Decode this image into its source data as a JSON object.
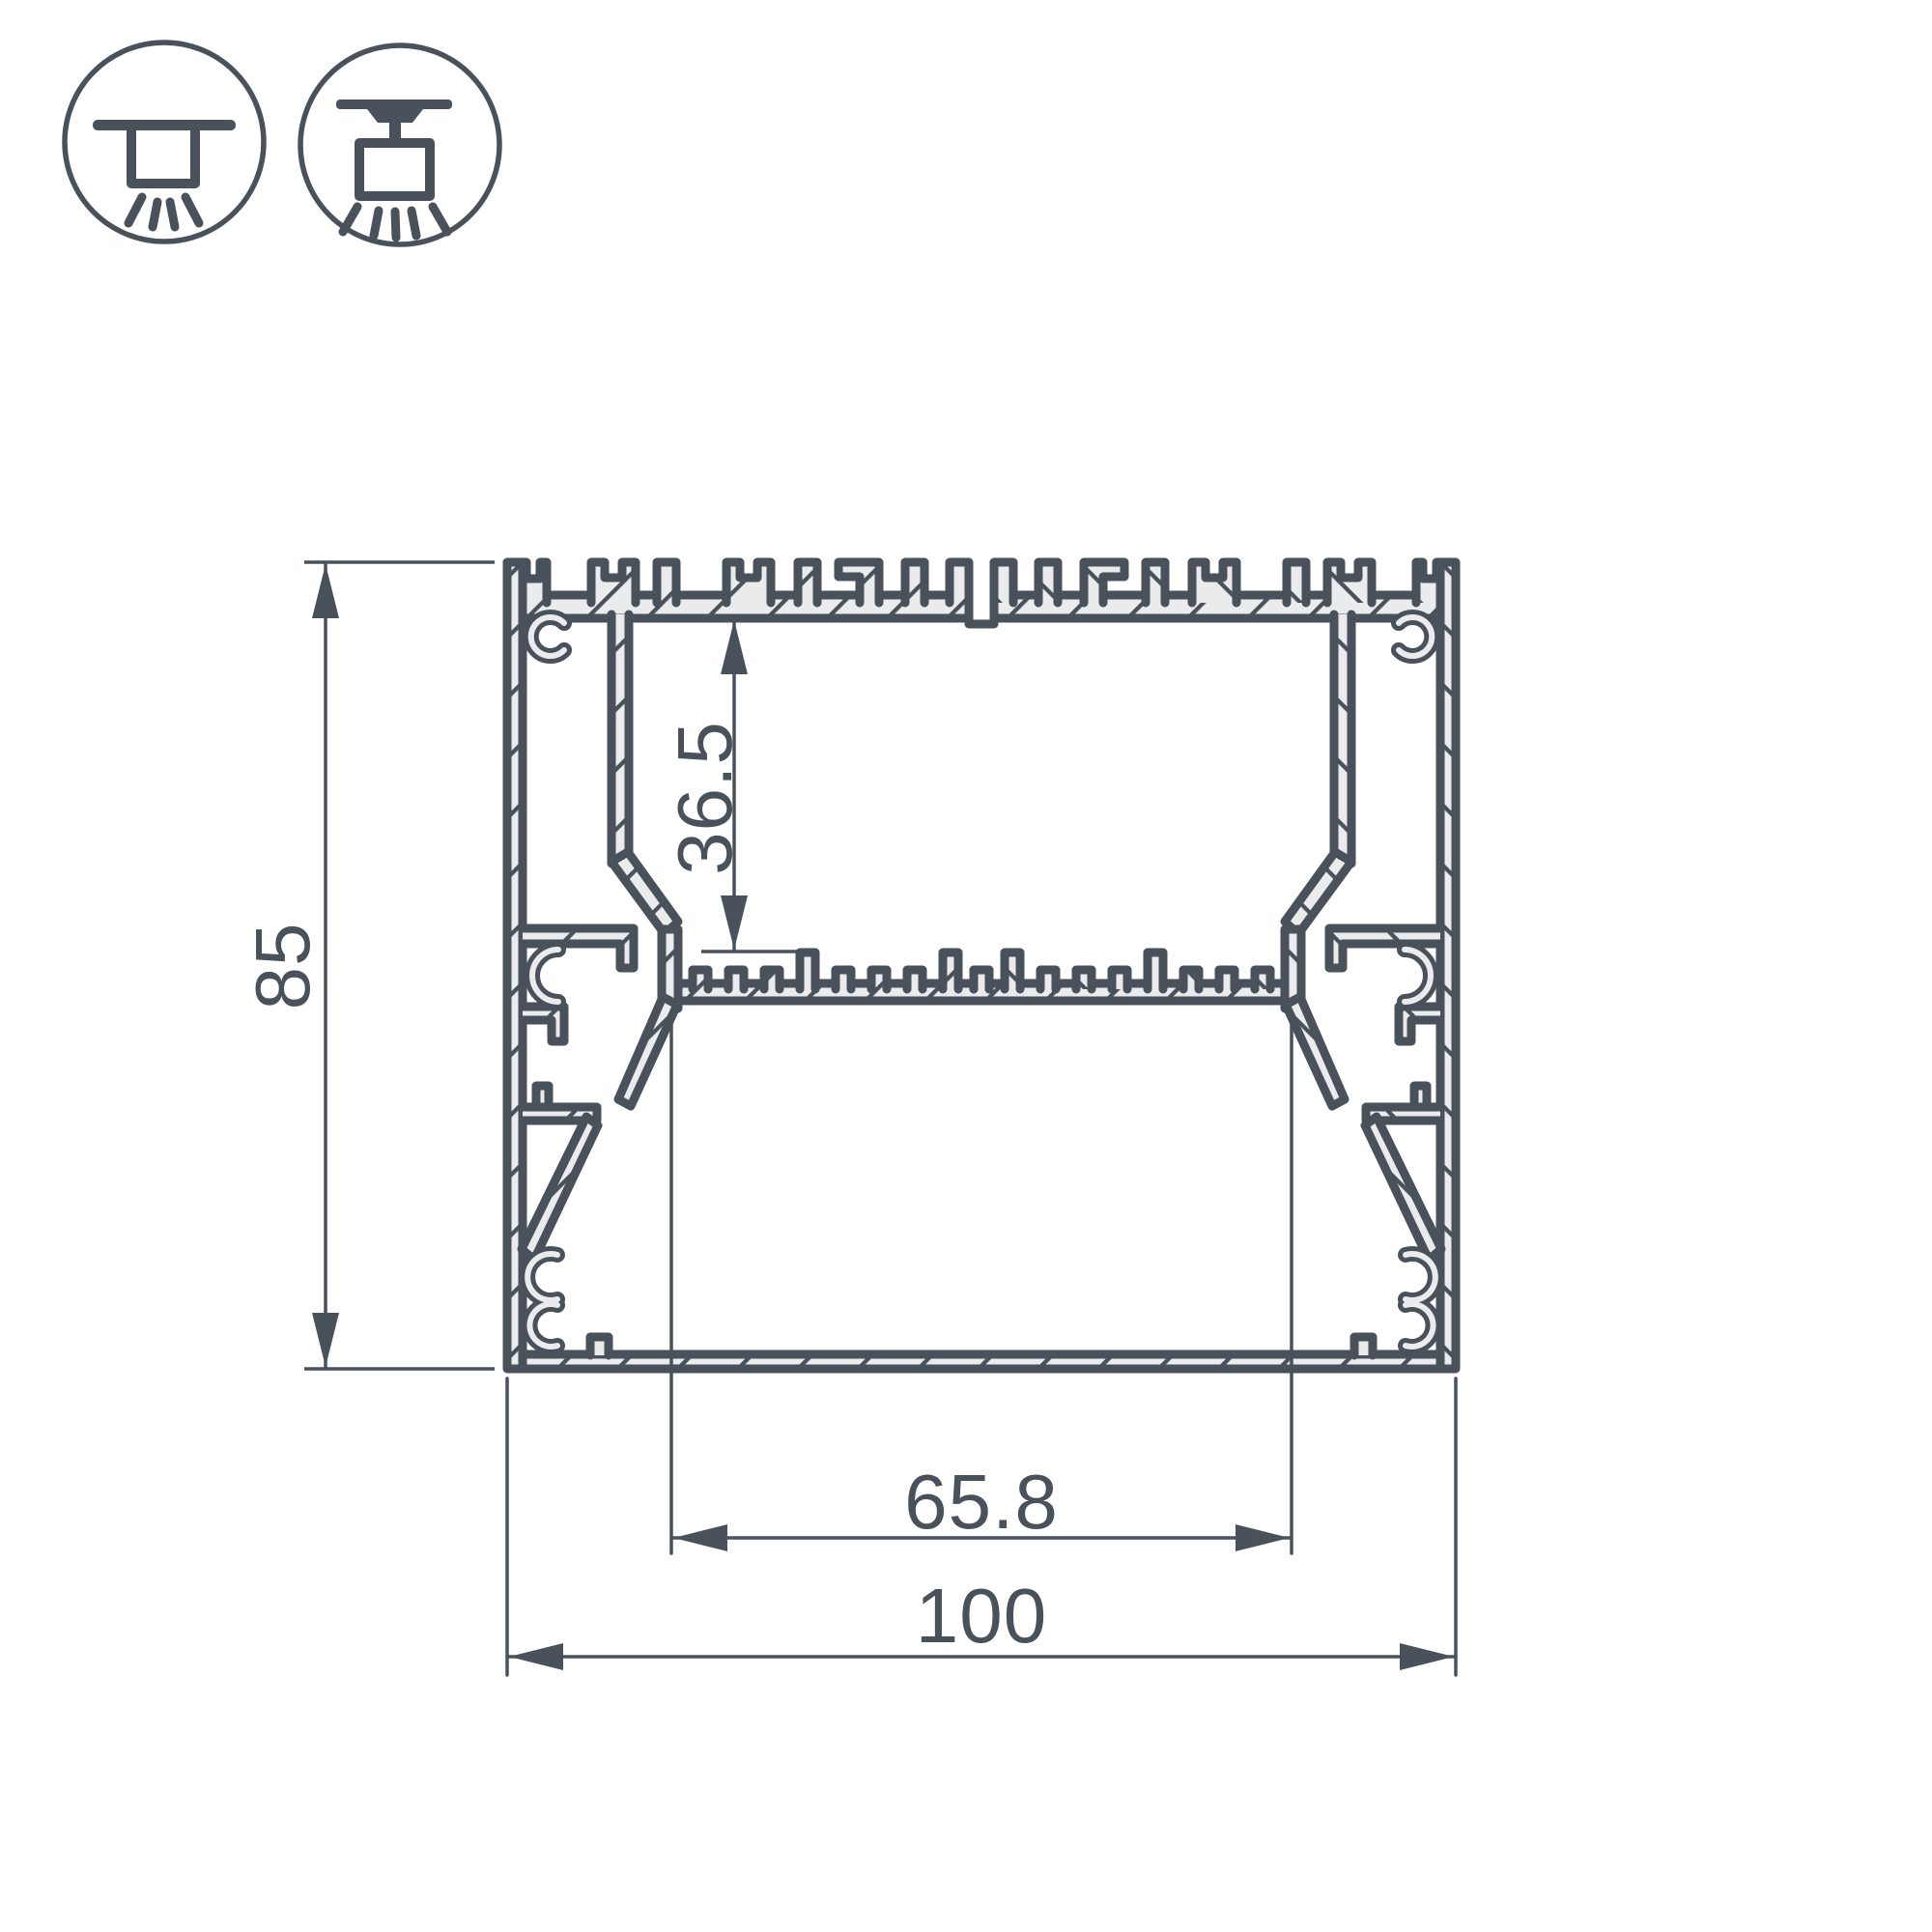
{
  "drawing": {
    "kind": "aluminium-led-profile-cross-section",
    "colors": {
      "line": "#49525b",
      "metal_fill": "#eaebec",
      "background": "#ffffff"
    },
    "icons": {
      "surface": {
        "name": "surface-mount-luminaire-icon"
      },
      "pendant": {
        "name": "pendant-mount-luminaire-icon"
      }
    },
    "dimensions": {
      "overall_height": {
        "value": "85"
      },
      "cavity_depth": {
        "value": "36.5"
      },
      "inner_width": {
        "value": "65.8"
      },
      "overall_width": {
        "value": "100"
      }
    }
  }
}
